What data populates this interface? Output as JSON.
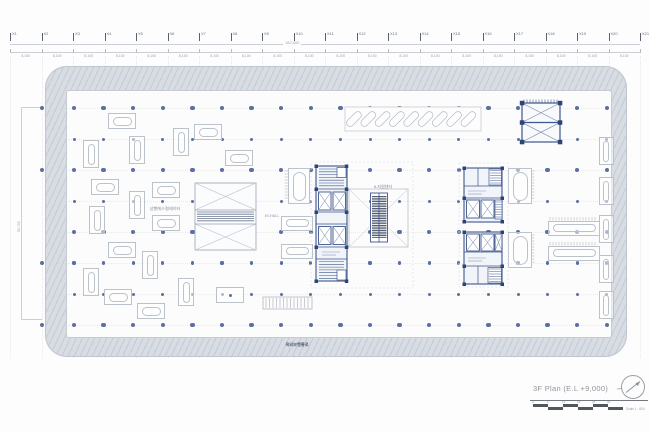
{
  "drawing": {
    "title": "3F Plan (E.L +9,000)",
    "scale_text": "Scale 1 : 600",
    "scalebar_ticks": [
      "0",
      "6",
      "12",
      "18",
      "24",
      "30"
    ]
  },
  "grid": {
    "x_labels": [
      "X1",
      "X2",
      "X3",
      "X4",
      "X5",
      "X6",
      "X7",
      "X8",
      "X9",
      "X10",
      "X11",
      "X12",
      "X13",
      "X14",
      "X15",
      "X16",
      "X17",
      "X18",
      "X19",
      "X20",
      "X21"
    ],
    "bay_dim": "8,100",
    "total_dim": "162,000",
    "left_dim": "56,700"
  },
  "rooms": {
    "center_hall": "6-지원센터",
    "escalator": "상행에스컬레이터",
    "ev_hall": "EV.HALL",
    "walkway": "옥외보행통로"
  },
  "colors": {
    "column_dot": "#5b6fa0",
    "core_blue": "#3f568c",
    "dark_wall": "#2e4472",
    "band_gray": "#d8dce3",
    "furniture": "#bcc2ca",
    "dimension": "#9aa1aa"
  },
  "columns": {
    "x0": 74,
    "dx": 29.6,
    "count": 19,
    "rows": [
      {
        "y": 108,
        "r": 2.2
      },
      {
        "y": 139,
        "r": 1.5
      },
      {
        "y": 170,
        "r": 2.2
      },
      {
        "y": 201,
        "r": 1.5
      },
      {
        "y": 232,
        "r": 2.2
      },
      {
        "y": 263,
        "r": 1.6
      },
      {
        "y": 294,
        "r": 1.5
      },
      {
        "y": 325,
        "r": 2.2
      }
    ],
    "ext_x": 42,
    "ext_rows": [
      108,
      170,
      263,
      325
    ]
  },
  "furniture": [
    {
      "x": 121,
      "y": 120,
      "o": "h"
    },
    {
      "x": 207,
      "y": 131,
      "o": "h"
    },
    {
      "x": 180,
      "y": 141,
      "o": "v"
    },
    {
      "x": 90,
      "y": 153,
      "o": "v"
    },
    {
      "x": 136,
      "y": 149,
      "o": "v"
    },
    {
      "x": 238,
      "y": 157,
      "o": "h"
    },
    {
      "x": 104,
      "y": 186,
      "o": "h"
    },
    {
      "x": 165,
      "y": 189,
      "o": "h"
    },
    {
      "x": 136,
      "y": 204,
      "o": "v"
    },
    {
      "x": 96,
      "y": 219,
      "o": "v"
    },
    {
      "x": 165,
      "y": 222,
      "o": "h"
    },
    {
      "x": 121,
      "y": 249,
      "o": "h"
    },
    {
      "x": 149,
      "y": 264,
      "o": "v"
    },
    {
      "x": 90,
      "y": 281,
      "o": "v"
    },
    {
      "x": 117,
      "y": 296,
      "o": "h"
    },
    {
      "x": 150,
      "y": 310,
      "o": "h"
    },
    {
      "x": 185,
      "y": 291,
      "o": "v"
    },
    {
      "x": 229,
      "y": 294,
      "o": "h",
      "t": "dot"
    },
    {
      "x": 296,
      "y": 222,
      "o": "h",
      "w": 30,
      "h": 13
    },
    {
      "x": 296,
      "y": 250,
      "o": "h",
      "w": 30,
      "h": 13
    },
    {
      "x": 298,
      "y": 185,
      "o": "v",
      "w": 20,
      "h": 34
    },
    {
      "x": 519,
      "y": 185,
      "o": "v",
      "w": 22,
      "h": 34
    },
    {
      "x": 519,
      "y": 249,
      "o": "v",
      "w": 22,
      "h": 34
    },
    {
      "x": 573,
      "y": 227,
      "o": "h",
      "w": 50,
      "h": 13
    },
    {
      "x": 573,
      "y": 252,
      "o": "h",
      "w": 50,
      "h": 13
    },
    {
      "x": 605,
      "y": 150,
      "o": "v",
      "w": 13,
      "h": 26
    },
    {
      "x": 605,
      "y": 190,
      "o": "v",
      "w": 13,
      "h": 26
    },
    {
      "x": 605,
      "y": 228,
      "o": "v",
      "w": 13,
      "h": 26
    },
    {
      "x": 605,
      "y": 268,
      "o": "v",
      "w": 13,
      "h": 26
    },
    {
      "x": 605,
      "y": 304,
      "o": "v",
      "w": 13,
      "h": 26
    }
  ]
}
